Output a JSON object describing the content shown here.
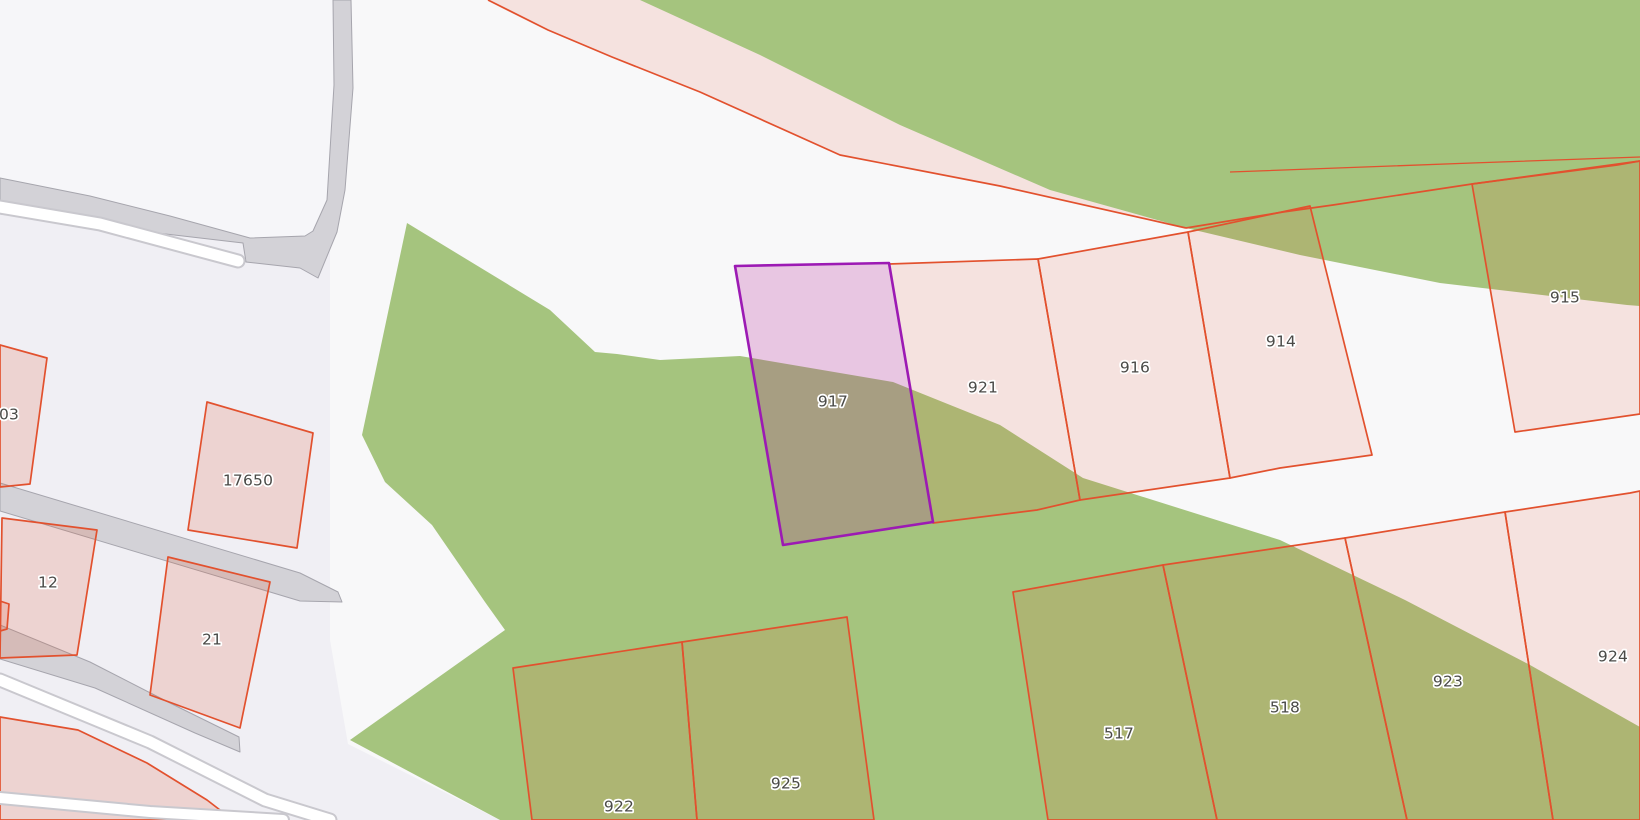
{
  "map": {
    "type": "cadastral-parcel-map",
    "selected_parcel": "917",
    "parcel_numbers": [
      "03",
      "17650",
      "12",
      "21",
      "917",
      "921",
      "916",
      "914",
      "915",
      "922",
      "925",
      "517",
      "518",
      "923",
      "924"
    ],
    "palette": {
      "base": "#f0eff4",
      "white_area": "#f8f8f9",
      "inner_area": "#f6f6f9",
      "green": "#a5c47e",
      "road_fill": "#d3d2d7",
      "road_edge": "#a6a5ad",
      "path_casing": "#c9c8ce",
      "path_white": "#ffffff",
      "parcel_fill": "rgba(228,77,38,0.12)",
      "parcel_fill_strong": "rgba(228,77,38,0.17)",
      "parcel_stroke": "#e2512e",
      "selected_fill": "rgba(176,24,144,0.22)",
      "selected_stroke": "#9c1ab4",
      "label_color": "#4a4a47",
      "label_halo": "#ffffff"
    },
    "shapes": [
      {
        "name": "background",
        "kind": "polygon",
        "points": "0,0 1640,0 1640,820 0,820",
        "fill": "base",
        "interactable": false
      },
      {
        "name": "white-landuse-area",
        "kind": "polygon",
        "points": "330,0 1640,0 1640,820 500,820 348,744 330,640",
        "fill": "white_area",
        "interactable": false
      },
      {
        "name": "enclosed-area-topleft",
        "kind": "polygon",
        "points": "0,0 333,0 334,85 327,200 313,231 305,236 250,238 170,216 90,196 0,178",
        "fill": "inner_area",
        "interactable": false
      },
      {
        "name": "landuse-green-main",
        "kind": "polygon",
        "points": "407,223 550,310 595,352 617,354 660,360 740,356 893,382 1000,425 1083,478 1280,540 1405,600 1530,665 1640,727 1640,820 500,820 350,740 505,630 485,602 432,525 385,482 362,435",
        "fill": "green",
        "interactable": false
      },
      {
        "name": "landuse-green-northeast",
        "kind": "polygon",
        "points": "640,0 760,55 900,125 1050,190 1186,228 1300,255 1440,283 1627,305 1640,306 1640,0",
        "fill": "green",
        "interactable": false
      },
      {
        "name": "parcel-band-north",
        "kind": "polygon",
        "points": "488,0 548,30 612,57 700,92 840,155 1000,186 1186,228 1050,190 900,125 760,55 640,0",
        "fill": "parcel_fill",
        "interactable": true
      },
      {
        "name": "parcel-boundary-band",
        "kind": "polyline",
        "points": "488,0 548,30 612,57 700,92 840,155 1000,186 1186,228",
        "stroke": "parcel_stroke",
        "width": 1.7,
        "interactable": false
      },
      {
        "name": "road-main",
        "kind": "polygon",
        "points": "0,178 90,196 170,216 250,238 305,236 313,231 327,200 334,85 333,0 351,0 353,88 345,190 337,232 318,278 300,268 246,262 243,243 140,231 0,214",
        "fill": "road_fill",
        "stroke": "road_edge",
        "width": 1,
        "interactable": true
      },
      {
        "name": "footpath-top-casing",
        "kind": "polyline",
        "points": "0,207 100,224 238,261",
        "stroke": "path_casing",
        "width": 15,
        "cap": "round",
        "interactable": false
      },
      {
        "name": "footpath-top",
        "kind": "polyline",
        "points": "0,207 100,224 238,261",
        "stroke": "path_white",
        "width": 11,
        "cap": "round",
        "interactable": true
      },
      {
        "name": "road-west-upper",
        "kind": "polygon",
        "points": "0,483 300,573 338,592 342,602 300,601 0,511",
        "fill": "road_fill",
        "stroke": "road_edge",
        "width": 1,
        "interactable": true
      },
      {
        "name": "road-west-lower",
        "kind": "polygon",
        "points": "0,625 90,662 170,703 239,737 240,752 195,733 95,688 0,659",
        "fill": "road_fill",
        "stroke": "road_edge",
        "width": 1,
        "interactable": true
      },
      {
        "name": "parcel-03",
        "kind": "polygon",
        "points": "0,345 47,358 30,484 0,487",
        "fill": "parcel_fill_strong",
        "stroke": "parcel_stroke",
        "width": 1.7,
        "interactable": true
      },
      {
        "name": "parcel-17650",
        "kind": "polygon",
        "points": "207,402 313,433 297,548 188,530",
        "fill": "parcel_fill_strong",
        "stroke": "parcel_stroke",
        "width": 1.7,
        "interactable": true
      },
      {
        "name": "parcel-12",
        "kind": "polygon",
        "points": "2,518 97,530 77,655 0,658",
        "fill": "parcel_fill_strong",
        "stroke": "parcel_stroke",
        "width": 1.7,
        "interactable": true
      },
      {
        "name": "parcel-stub-west",
        "kind": "polygon",
        "points": "0,601 9,604 7,629 0,631",
        "fill": "parcel_fill_strong",
        "stroke": "parcel_stroke",
        "width": 1.7,
        "interactable": true
      },
      {
        "name": "parcel-21",
        "kind": "polygon",
        "points": "168,557 270,582 240,728 150,695",
        "fill": "parcel_fill_strong",
        "stroke": "parcel_stroke",
        "width": 1.7,
        "interactable": true
      },
      {
        "name": "parcel-southwest",
        "kind": "polygon",
        "points": "0,717 78,730 147,763 207,800 233,820 0,820",
        "fill": "parcel_fill_strong",
        "stroke": "parcel_stroke",
        "width": 1.7,
        "interactable": true
      },
      {
        "name": "parcel-921",
        "kind": "polygon",
        "points": "889,264 1038,259 1080,500 1037,510 933,523",
        "fill": "parcel_fill",
        "stroke": "parcel_stroke",
        "width": 1.7,
        "interactable": true
      },
      {
        "name": "parcel-916",
        "kind": "polygon",
        "points": "1038,259 1188,232 1230,478 1080,500",
        "fill": "parcel_fill",
        "stroke": "parcel_stroke",
        "width": 1.7,
        "interactable": true
      },
      {
        "name": "parcel-914",
        "kind": "polygon",
        "points": "1188,232 1310,206 1372,455 1280,468 1230,478",
        "fill": "parcel_fill",
        "stroke": "parcel_stroke",
        "width": 1.7,
        "interactable": true
      },
      {
        "name": "parcel-915",
        "kind": "polygon",
        "points": "1472,184 1640,161 1640,414 1515,432",
        "fill": "parcel_fill",
        "stroke": "parcel_stroke",
        "width": 1.7,
        "interactable": true
      },
      {
        "name": "parcel-boundary-northeast",
        "kind": "polyline",
        "points": "1186,228 1283,212 1333,205 1472,184 1617,165 1640,161",
        "stroke": "parcel_stroke",
        "width": 1.7,
        "interactable": false
      },
      {
        "name": "parcel-boundary-upper-sliver",
        "kind": "polyline",
        "points": "1230,172 1472,163 1640,157",
        "stroke": "parcel_stroke",
        "width": 1.3,
        "interactable": false
      },
      {
        "name": "parcel-922",
        "kind": "polygon",
        "points": "513,668 682,642 697,820 532,820",
        "fill": "parcel_fill",
        "stroke": "parcel_stroke",
        "width": 1.7,
        "interactable": true
      },
      {
        "name": "parcel-925",
        "kind": "polygon",
        "points": "682,642 847,617 874,820 697,820",
        "fill": "parcel_fill",
        "stroke": "parcel_stroke",
        "width": 1.7,
        "interactable": true
      },
      {
        "name": "parcel-517",
        "kind": "polygon",
        "points": "1013,592 1163,565 1217,820 1048,820",
        "fill": "parcel_fill",
        "stroke": "parcel_stroke",
        "width": 1.7,
        "interactable": true
      },
      {
        "name": "parcel-518",
        "kind": "polygon",
        "points": "1163,565 1345,538 1407,820 1217,820",
        "fill": "parcel_fill",
        "stroke": "parcel_stroke",
        "width": 1.7,
        "interactable": true
      },
      {
        "name": "parcel-923",
        "kind": "polygon",
        "points": "1345,538 1505,512 1553,820 1407,820",
        "fill": "parcel_fill",
        "stroke": "parcel_stroke",
        "width": 1.7,
        "interactable": true
      },
      {
        "name": "parcel-924",
        "kind": "polygon",
        "points": "1505,512 1630,493 1640,491 1640,820 1553,820",
        "fill": "parcel_fill",
        "stroke": "parcel_stroke",
        "width": 1.7,
        "interactable": true
      },
      {
        "name": "footpath-southwest-casing",
        "kind": "polyline",
        "points": "0,680 150,742 265,800 330,820",
        "stroke": "path_casing",
        "width": 15,
        "cap": "round",
        "interactable": false
      },
      {
        "name": "footpath-southwest",
        "kind": "polyline",
        "points": "0,680 150,742 265,800 330,820",
        "stroke": "path_white",
        "width": 11,
        "cap": "round",
        "interactable": true
      },
      {
        "name": "footpath-bottom-casing",
        "kind": "polyline",
        "points": "0,798 150,812 283,820",
        "stroke": "path_casing",
        "width": 14,
        "cap": "round",
        "interactable": false
      },
      {
        "name": "footpath-bottom",
        "kind": "polyline",
        "points": "0,798 150,812 283,820",
        "stroke": "path_white",
        "width": 10,
        "cap": "round",
        "interactable": true
      },
      {
        "name": "parcel-917-selected",
        "kind": "polygon",
        "points": "735,266 889,263 933,522 783,545",
        "fill": "selected_fill",
        "stroke": "selected_stroke",
        "width": 2.6,
        "interactable": true
      }
    ],
    "labels": [
      {
        "text": "03",
        "x": 9,
        "y": 415
      },
      {
        "text": "17650",
        "x": 248,
        "y": 481
      },
      {
        "text": "12",
        "x": 48,
        "y": 583
      },
      {
        "text": "21",
        "x": 212,
        "y": 640
      },
      {
        "text": "917",
        "x": 833,
        "y": 402
      },
      {
        "text": "921",
        "x": 983,
        "y": 388
      },
      {
        "text": "916",
        "x": 1135,
        "y": 368
      },
      {
        "text": "914",
        "x": 1281,
        "y": 342
      },
      {
        "text": "915",
        "x": 1565,
        "y": 298
      },
      {
        "text": "922",
        "x": 619,
        "y": 807
      },
      {
        "text": "925",
        "x": 786,
        "y": 784
      },
      {
        "text": "517",
        "x": 1119,
        "y": 734
      },
      {
        "text": "518",
        "x": 1285,
        "y": 708
      },
      {
        "text": "923",
        "x": 1448,
        "y": 682
      },
      {
        "text": "924",
        "x": 1613,
        "y": 657
      }
    ]
  }
}
